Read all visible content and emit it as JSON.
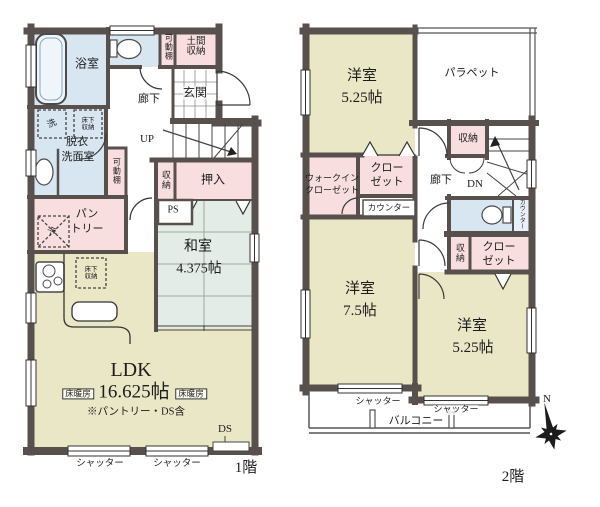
{
  "floor1": {
    "floor_label": "1階",
    "bath": "浴室",
    "movable_shelf": "可動棚",
    "movable_shelf2": "可動棚",
    "doma_storage": "土間収納",
    "entrance": "玄関",
    "hallway": "廊下",
    "stairs_up": "UP",
    "washer": "洗",
    "underfloor_storage": "床下収納",
    "washroom_line1": "脱衣",
    "washroom_line2": "洗面室",
    "storage": "収納",
    "oshiire": "押入",
    "ps": "PS",
    "washitsu": "和室",
    "washitsu_size": "4.375帖",
    "pantry_line1": "パン",
    "pantry_line2": "トリー",
    "fridge": "冷",
    "ldk": "LDK",
    "ldk_size": "16.625帖",
    "ldk_note": "※パントリー・DS含",
    "floor_heating": "床暖房",
    "ds": "DS",
    "shutter": "シャッター"
  },
  "floor2": {
    "floor_label": "2階",
    "room1": "洋室",
    "room1_size": "5.25帖",
    "parapet": "パラペット",
    "storage_top": "収納",
    "wic_line1": "ウォークイン",
    "wic_line2": "クローゼット",
    "closet_line1": "クロー",
    "closet_line2": "ゼット",
    "counter": "カウンター",
    "hallway": "廊下",
    "stairs_down": "DN",
    "counter_small": "カウンター",
    "storage_bottom": "収納",
    "room2": "洋室",
    "room2_size": "7.5帖",
    "room3": "洋室",
    "room3_size": "5.25帖",
    "balcony": "バルコニー",
    "shutter": "シャッター"
  },
  "compass": {
    "north": "N"
  },
  "colors": {
    "wall": "#57504c",
    "room_beige": "#eae7c6",
    "room_blue": "#d8e6f2",
    "room_pink": "#f8dede",
    "tatami": "#e3ece6"
  }
}
